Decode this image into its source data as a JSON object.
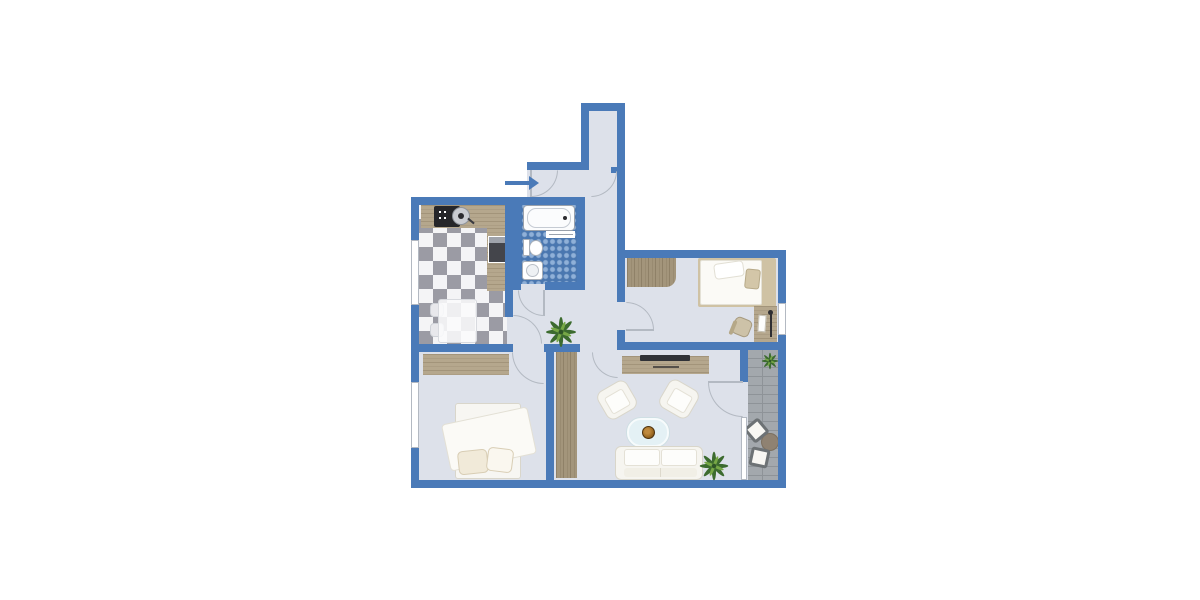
{
  "meta": {
    "type": "apartment-floor-plan",
    "canvas_width": 1200,
    "canvas_height": 600,
    "text_labels": []
  },
  "colors": {
    "wall": "#4a7ab8",
    "exterior": "#ffffff",
    "floor": "#dde1ea",
    "line": "#b3b9c2",
    "wood": "#b5a78d",
    "wood-dark": "#a3957b",
    "deck": "#a3a8ad",
    "deck-line": "#8e9398",
    "checker-gray": "#9b9ba4",
    "checker-white": "#f4f4f6",
    "tile-base": "#4a77b0",
    "tile-dot": "#8fb0d8",
    "furn": "#f6f5f0",
    "furn-border": "#d9d6ca",
    "fridge": "#44454b",
    "tv": "#303237",
    "glass": "#e4f1f5",
    "bowl": "#9c6a22",
    "plant-dark": "#3c6b2f",
    "plant-light": "#76a746",
    "beige": "#d3c6a8",
    "metal": "#4c4f55"
  },
  "entrance": {
    "marker": "arrow-icon",
    "direction": "right"
  },
  "rooms": [
    {
      "name": "entry-hall",
      "features": [
        "entry-door",
        "corridor-door",
        "entrance-arrow"
      ]
    },
    {
      "name": "kitchen",
      "features": [
        "counter",
        "cooktop",
        "kitchen-sink",
        "fridge",
        "dining-table",
        "chairs",
        "checkered-floor",
        "window"
      ]
    },
    {
      "name": "bathroom",
      "features": [
        "bathtub",
        "toilet",
        "washbasin",
        "towel-rail",
        "mosaic-floor",
        "door"
      ]
    },
    {
      "name": "bedroom-top-right",
      "features": [
        "sideboard",
        "double-bed",
        "pillows",
        "desk",
        "desk-chair",
        "window",
        "door"
      ]
    },
    {
      "name": "hallway",
      "features": [
        "plant",
        "tall-wardrobe"
      ]
    },
    {
      "name": "living-room",
      "features": [
        "tv-sideboard",
        "tv",
        "armchair-left",
        "armchair-right",
        "coffee-table",
        "decorative-bowl",
        "sofa",
        "plant",
        "balcony-door"
      ]
    },
    {
      "name": "bedroom-bottom-left",
      "features": [
        "wardrobe",
        "double-bed",
        "duvet",
        "pillows",
        "window",
        "door"
      ]
    },
    {
      "name": "balcony",
      "features": [
        "wood-decking",
        "plant",
        "lounge-chair-1",
        "lounge-chair-2",
        "round-table",
        "window-wall"
      ]
    }
  ]
}
